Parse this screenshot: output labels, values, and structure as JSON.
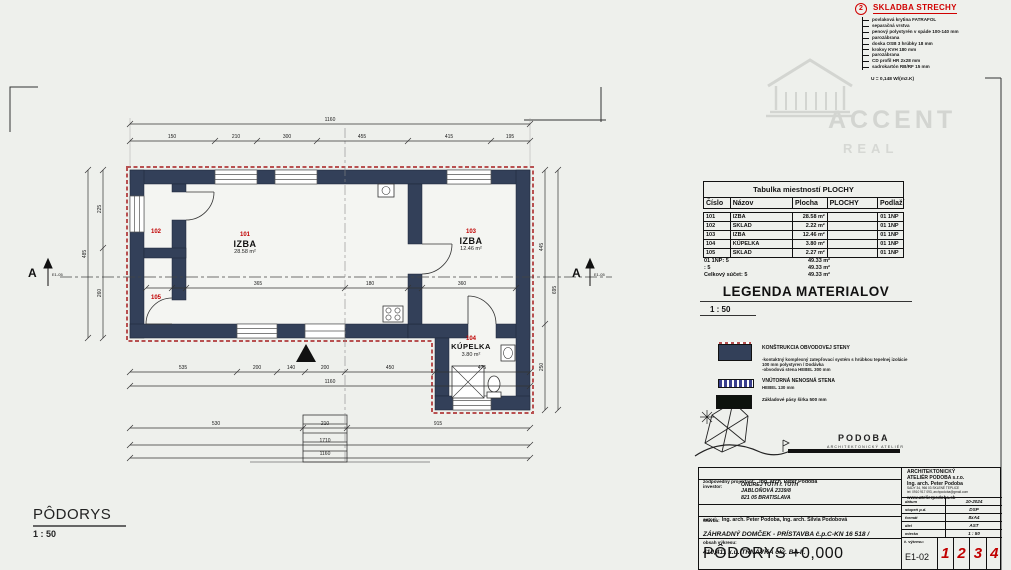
{
  "colors": {
    "wall": "#334059",
    "accent_red": "#c00000",
    "insulation_red": "#b85050",
    "background": "#eef0ec",
    "watermark_gray": "#d3d5d1"
  },
  "roof_assembly": {
    "marker": "2",
    "title": "SKLADBA STRECHY",
    "layers": [
      "povlaková krytina FATRAFOL",
      "separačná vrstva",
      "penový polystyrén v spáde 100-140 mm",
      "parozábrana",
      "doska OSB 3 hrúbky 18 mm",
      "krokvy KVH 180 mm",
      "parozábrana",
      "CD profil HR 2x28 mm",
      "sadrokartón RB/RF 15 mm"
    ],
    "u_value": "U = 0,148 W/(m2.K)"
  },
  "watermark": {
    "brand": "ACCENT",
    "sub": "REAL"
  },
  "room_table": {
    "title": "Tabulka miestností  PLOCHY",
    "headers": [
      "Číslo",
      "Názov",
      "Plocha",
      "PLOCHY",
      "Podlaží"
    ],
    "rows": [
      [
        "101",
        "IZBA",
        "28.58 m²",
        "",
        "01 1NP"
      ],
      [
        "102",
        "SKLAD",
        "2.22 m²",
        "",
        "01 1NP"
      ],
      [
        "103",
        "IZBA",
        "12.46 m²",
        "",
        "01 1NP"
      ],
      [
        "104",
        "KÚPELKA",
        "3.80 m²",
        "",
        "01 1NP"
      ],
      [
        "105",
        "SKLAD",
        "2.27 m²",
        "",
        "01 1NP"
      ]
    ],
    "summary": [
      [
        "01 1NP: 5",
        "49.33 m²"
      ],
      [
        ": 5",
        "49.33 m²"
      ],
      [
        "Celkový súčet: 5",
        "49.33 m²"
      ]
    ]
  },
  "legend": {
    "title": "LEGENDA MATERIALOV",
    "scale": "1 : 50",
    "items": [
      {
        "title": "KONŠTRUKCIA OBVODOVEJ STENY",
        "desc1": "-kontaktný komplexný zatepľovací systém s hrúbkou tepelnej izolácie",
        "desc2": "100 mm  polystyren / Dodávka",
        "desc3": "-obvodová stena HEBEL 300 mm"
      },
      {
        "title": "VNÚTORNÁ NENOSNÁ STENA",
        "desc1": "HEBEL  130 mm"
      },
      {
        "title": "Základové pásy šírka 500 mm"
      }
    ]
  },
  "atelier_logo": {
    "name": "PODOBA",
    "subtitle": "ARCHITEKTONICKÝ ATELIÉR"
  },
  "plan": {
    "rooms": [
      {
        "num": "101",
        "name": "IZBA",
        "area": "28.58 m²"
      },
      {
        "num": "102"
      },
      {
        "num": "103",
        "name": "IZBA",
        "area": "12.46 m²"
      },
      {
        "num": "104",
        "name": "KÚPELKA",
        "area": "3.80 m²"
      },
      {
        "num": "105"
      }
    ],
    "section": {
      "label": "A",
      "ref": "E1-05"
    },
    "dims": {
      "top": [
        "150",
        "210",
        "300",
        "455",
        "415",
        "195"
      ],
      "top_overall": "1160",
      "bottom": [
        "535",
        "200",
        "140",
        "200",
        "450",
        "475"
      ],
      "bottom_overall": "1160",
      "bottom2": [
        "530",
        "210",
        "915"
      ],
      "steps": [
        "1710",
        "1160"
      ],
      "left": [
        "225",
        "260"
      ],
      "left_overall": "485",
      "right": [
        "445",
        "250"
      ],
      "right_overall": "695",
      "interior": [
        "365",
        "180",
        "360"
      ]
    }
  },
  "footer_label": {
    "title": "PÔDORYS",
    "scale": "1 : 50"
  },
  "titleblock": {
    "row1_label": "zodpovedný  projektant:",
    "row1_value": "Ing. arch. Peter Podoba",
    "investor_label": "investor:",
    "investor_line1": "ONDREJ TOTH r. TOTH",
    "investor_line2": "JABLOŇOVÁ 2339/8",
    "investor_line3": "821 05 BRATISLAVA",
    "authors_label": "autori:",
    "authors_value": "Ing. arch. Peter Podoba, Ing. arch. Silvia Podobová",
    "stavba_label": "Stavba:",
    "stavba_line1": "ZÁHRADNÝ DOMČEK - PRÍSTAVBA   č.p.C-KN 16 518 /",
    "stavba_line2": "410,411 k.ú. TRNÁVKA  okr. BA II.",
    "content_label": "obsah výkresu:",
    "content_value": "PÔDORYS +0,000",
    "office_line1": "ARCHITEKTONICKÝ",
    "office_line2": "ATELIÉR PODOBA s.r.o.",
    "office_line3": "Ing. arch. Peter Podoba",
    "office_small1": "SADY 34, 966 03 SKLENÉ TEPLICE",
    "office_small2": "tel: 0910 917 093, archpodoba@gmail.com",
    "office_web": "www.atelierpodoba.sk",
    "meta": [
      {
        "label": "dátum",
        "value": "10-2024"
      },
      {
        "label": "stupeň p.d.",
        "value": "DSP"
      },
      {
        "label": "formát",
        "value": "8xA4"
      },
      {
        "label": "diel",
        "value": "AST"
      },
      {
        "label": "mierka",
        "value": "1 : 50"
      }
    ],
    "drawing_no_label": "č. výkresu:",
    "drawing_no": "E1-02",
    "pages": [
      "1",
      "2",
      "3",
      "4"
    ]
  }
}
